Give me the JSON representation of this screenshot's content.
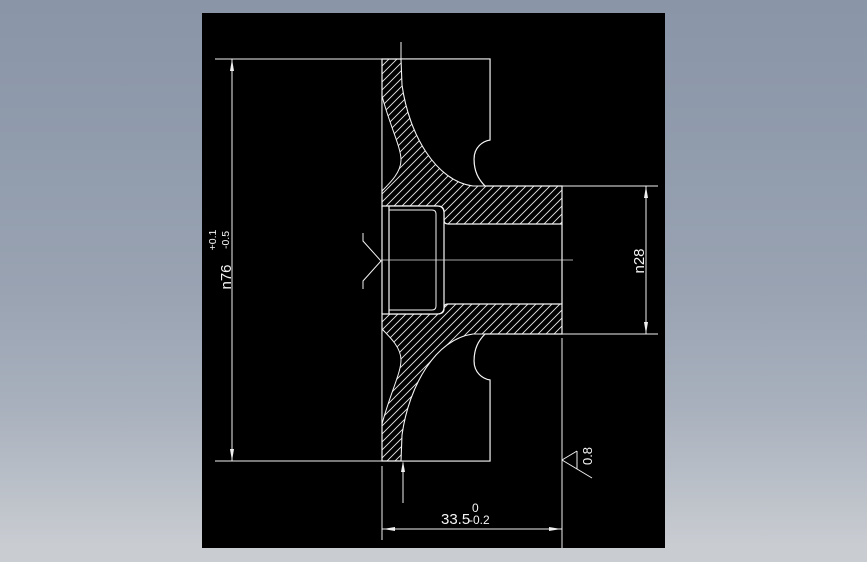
{
  "window": {
    "colors": {
      "desktop_top": "#8a95a8",
      "desktop_bottom": "#c9ccd1",
      "canvas_background": "#000000",
      "line_color": "#ffffff"
    }
  },
  "dimensions": {
    "dia_outer": {
      "label": "n76",
      "tol_upper": "+0.1",
      "tol_lower": "-0.5"
    },
    "dia_hub": {
      "label": "n28"
    },
    "length": {
      "label": "33.5",
      "tol_upper": "0",
      "tol_lower": "-0.2"
    },
    "roughness": {
      "label": "0.8"
    }
  }
}
